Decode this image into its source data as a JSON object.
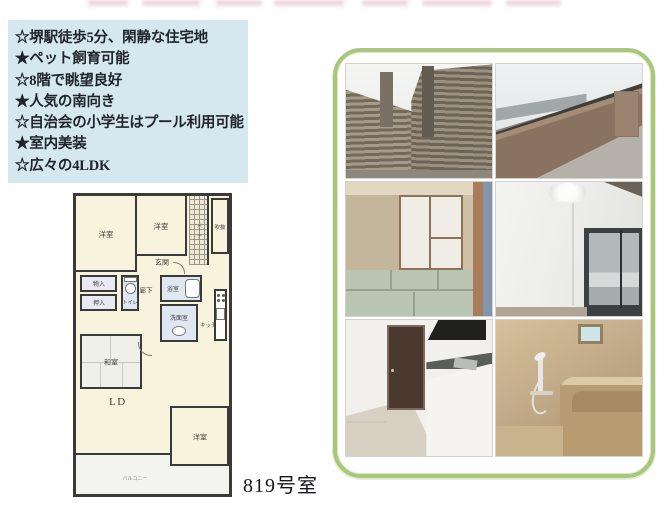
{
  "features": {
    "lines": [
      "☆堺駅徒歩5分、閑静な住宅地",
      "★ペット飼育可能",
      "☆8階で眺望良好",
      "★人気の南向き",
      "☆自治会の小学生はプール利用可能",
      "★室内美装",
      "☆広々の4LDK"
    ]
  },
  "floorplan": {
    "rooms": {
      "western1": "洋室",
      "western2": "洋室",
      "void_space": "吹抜",
      "porch": "ポーチ",
      "entrance": "玄関",
      "storage": "物入",
      "futon_closet": "押入",
      "toilet": "トイレ",
      "hallway": "廊下",
      "bath": "浴室",
      "washroom": "洗面室",
      "kitchen": "キッチン",
      "japanese_room": "和室",
      "living_dining": "LD",
      "western3": "洋室",
      "balcony": "バルコニー"
    },
    "room_number": "819号室"
  },
  "photos": [
    {
      "name": "building-exterior"
    },
    {
      "name": "balcony-view"
    },
    {
      "name": "japanese-room"
    },
    {
      "name": "western-room"
    },
    {
      "name": "kitchen"
    },
    {
      "name": "bathroom"
    }
  ],
  "colors": {
    "feature_box_bg": "#d5e7ef",
    "frame_green": "#a9c77c",
    "plan_wall": "#3a3a38",
    "plan_room_cream": "#f8f3dc",
    "plan_wet_blue": "#dfe7f3"
  }
}
